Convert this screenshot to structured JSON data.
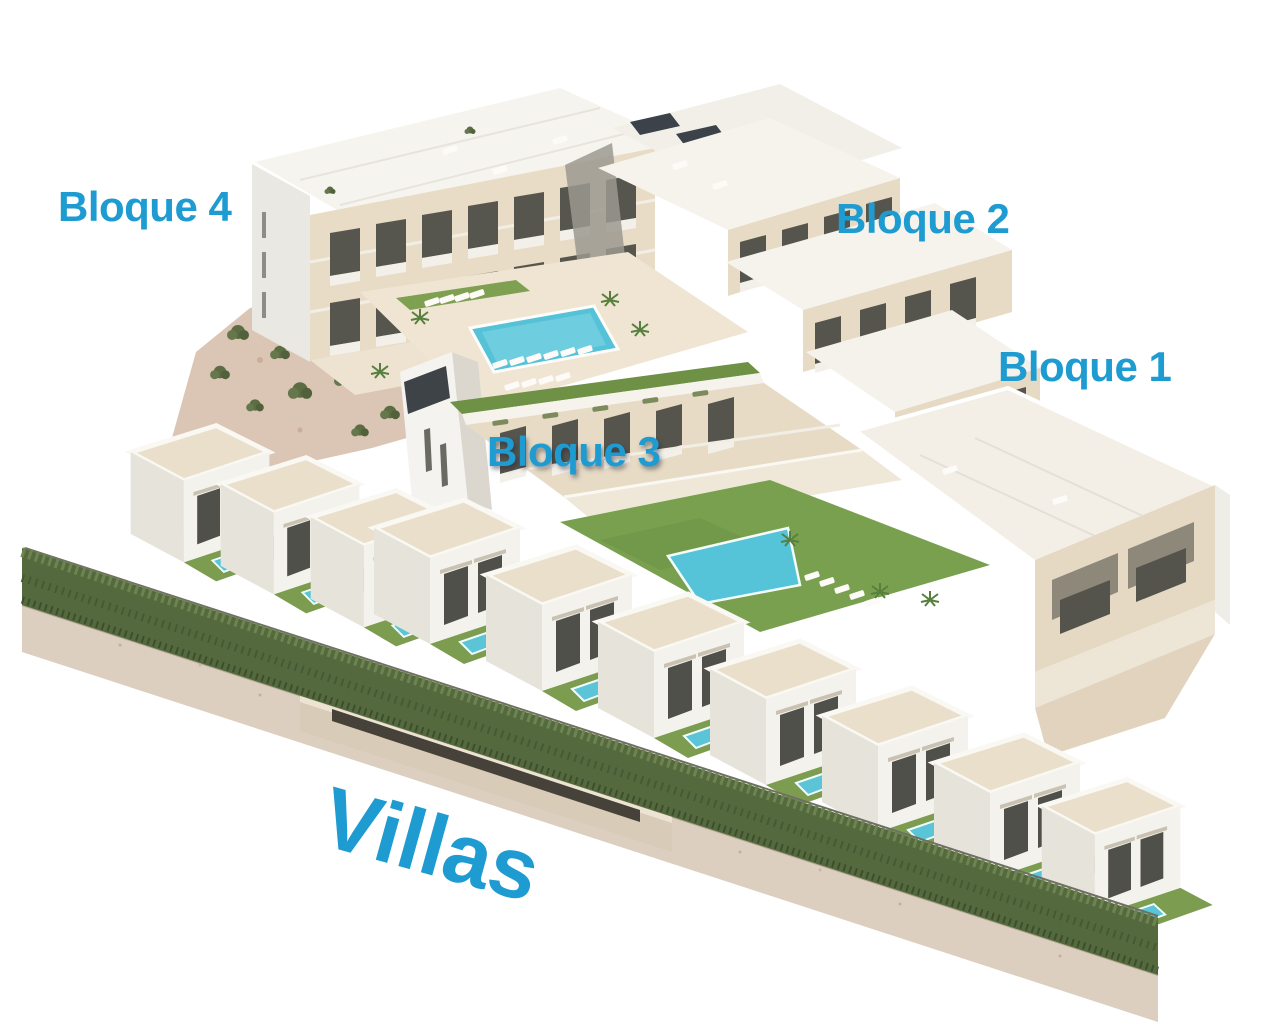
{
  "scene": {
    "labels": [
      {
        "id": "bloque-4",
        "text": "Bloque 4"
      },
      {
        "id": "bloque-2",
        "text": "Bloque 2"
      },
      {
        "id": "bloque-1",
        "text": "Bloque 1"
      },
      {
        "id": "bloque-3",
        "text": "Bloque 3"
      },
      {
        "id": "villas",
        "text": "Villas"
      }
    ],
    "colors": {
      "label_blue": "#1E9CD2",
      "facade_beige": "#E7DBC5",
      "roof_white": "#F5F3EC",
      "pool_turquoise": "#55C2D8",
      "lawn_green": "#7C9C4F",
      "hedge_green": "#55693E",
      "rock_tan": "#DBC5B4",
      "gravel_tan": "#DCCFC0",
      "solar_panel_dark": "#3B424A"
    }
  }
}
